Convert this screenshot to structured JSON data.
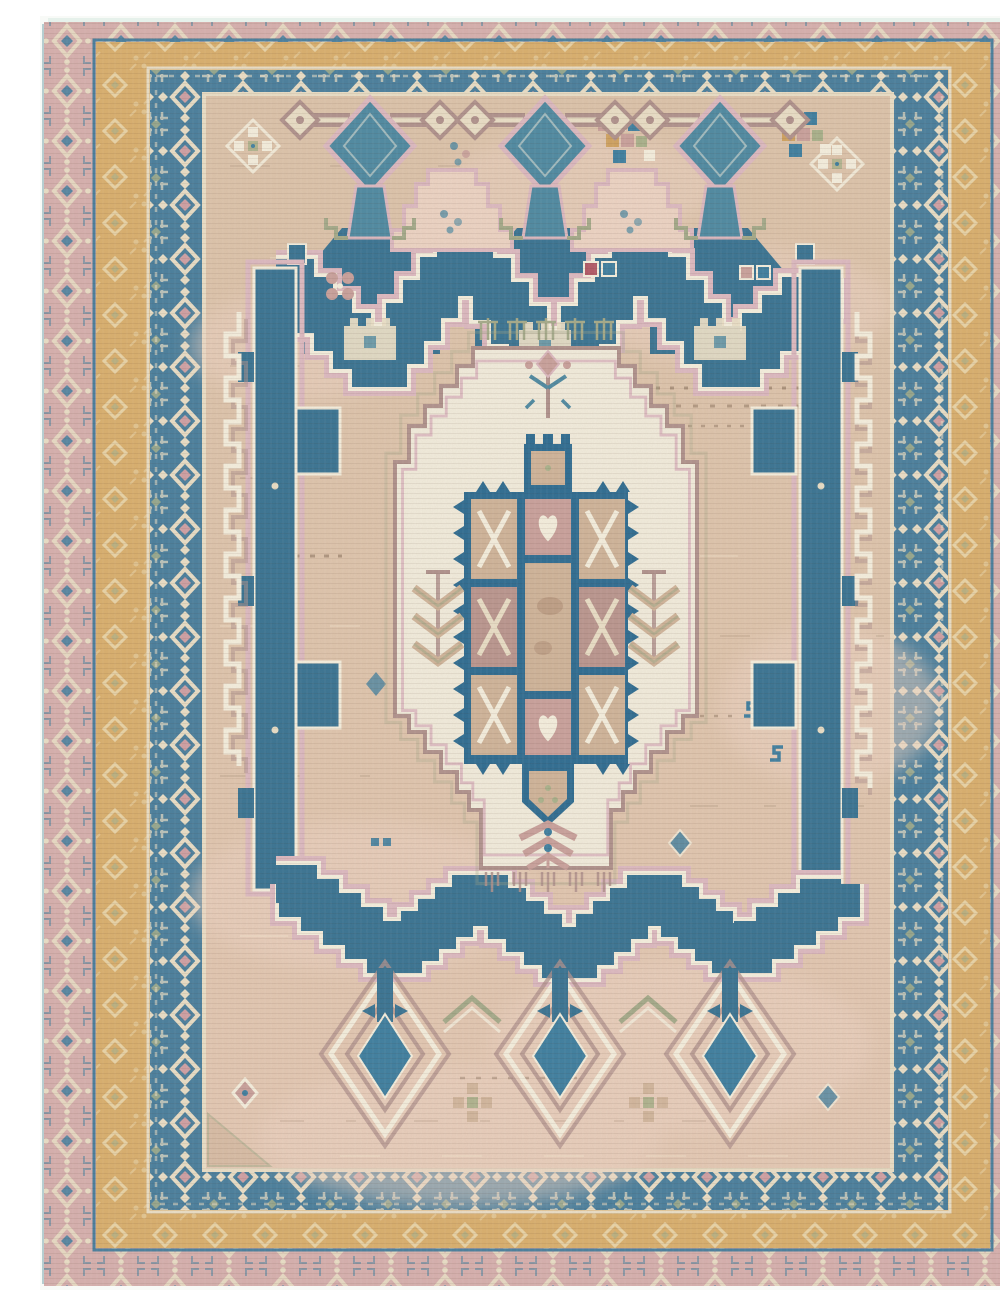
{
  "image": {
    "kind": "photograph",
    "subject": "Antique hand-knotted tribal rug with stepped medallion",
    "alt": "Antique tribal rug photograph: faded steel-blue stepped zigzag medallion with anchor pendants above and diamond drop pendants below, ivory stepped center medallion holding an indigo checkerboard, on a camel-tan abrash field, framed by dusty-pink, ochre-gold and indigo guard borders",
    "orientation": "portrait"
  },
  "palette": {
    "photo-bg": "#f8faf7",
    "selvedge": "#aec9cb",
    "pink-band": "#d6b0ae",
    "gold-band": "#d9af6e",
    "gold-motif": "#ecdcb4",
    "blue-band": "#4a7f9d",
    "band-motif-cream": "#e9dec6",
    "band-motif-pink": "#cfa0a4",
    "band-motif-green": "#a9b18b",
    "field": "#dcc3aa",
    "field-warm": "#ecd3c3",
    "ivory": "#f1ebdb",
    "outline-pink": "#dcb9c0",
    "outline-mauve": "#b0928d",
    "outline-white": "#f4eedd",
    "outline-green": "#a4aa8a",
    "med-blue": "#3a7493",
    "grid-blue": "#2f6d92",
    "teal": "#4f8aa2",
    "drop-blue": "#3f7fa0",
    "cell-tan": "#cfb49a",
    "cell-mauve": "#ba968f",
    "cell-brown": "#a8846e",
    "cell-pink": "#c9a19c",
    "accent-gold": "#cfa261",
    "accent-red": "#b25a67",
    "streak-dark": "#6b5340",
    "streak-light": "#f6e9d2"
  },
  "rug": {
    "field": {
      "color_name": "faded camel tan",
      "texture": "horizontal abrash streaks, dark flecks and pale rose patches"
    },
    "borders": [
      {
        "name": "outer guard border",
        "ground": "dusty pink",
        "motif": "cream diamond chain with indigo accents"
      },
      {
        "name": "middle guard border",
        "ground": "ochre gold",
        "motif": "faint cream lattice diamonds"
      },
      {
        "name": "main border",
        "ground": "steel indigo",
        "motif": "hooked diamond rosettes in cream, rose and sage"
      }
    ],
    "medallion": {
      "shape": "stepped zigzag lozenge band with crenellated sides",
      "top_pendants": 3,
      "bottom_pendants": 3,
      "center": "ivory stepped medallion enclosing an indigo checkerboard with heart and saltire cells, comb fringe, tulip stem and rose spray"
    },
    "small_motifs": [
      "checker diamond lattice",
      "square cluster",
      "S glyph",
      "comb fringe",
      "quatrefoil",
      "serrated leaf",
      "cloud hump",
      "fortress notch"
    ]
  }
}
